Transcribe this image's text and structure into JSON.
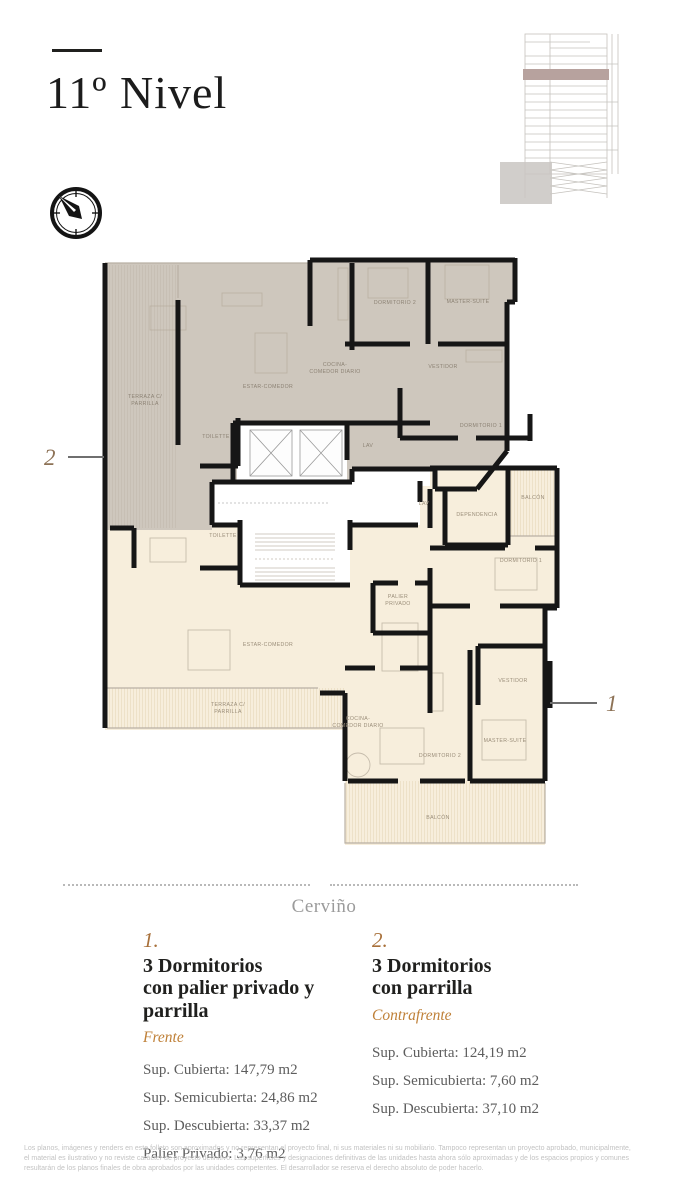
{
  "header": {
    "title": "11º Nivel"
  },
  "street": {
    "label": "Cerviño"
  },
  "plan": {
    "callout_1": "1",
    "callout_2": "2",
    "upper": {
      "terraza1": "TERRAZA C/",
      "terraza2": "PARRILLA",
      "estar": "ESTAR-COMEDOR",
      "cocina1": "COCINA-",
      "cocina2": "COMEDOR DIARIO",
      "dormitorio2": "DORMITORIO 2",
      "master": "MASTER-SUITE",
      "vestidor": "VESTIDOR",
      "dormitorio1": "DORMITORIO 1",
      "toilette": "TOILETTE",
      "lav": "LAV"
    },
    "lower": {
      "lav": "LAV",
      "toilette": "TOILETTE",
      "dependencia": "DEPENDENCIA",
      "balcon_top": "BALCÓN",
      "dormitorio1": "DORMITORIO 1",
      "palier1": "PALIER",
      "palier2": "PRIVADO",
      "estar": "ESTAR-COMEDOR",
      "terraza1": "TERRAZA C/",
      "terraza2": "PARRILLA",
      "cocina1": "COCINA-",
      "cocina2": "COMEDOR DIARIO",
      "dormitorio2": "DORMITORIO 2",
      "master": "MASTER-SUITE",
      "vestidor": "VESTIDOR",
      "balcon_bottom": "BALCÓN"
    }
  },
  "units": [
    {
      "number": "1.",
      "title": "3 Dormitorios\ncon palier privado y\nparrilla",
      "orientation": "Frente",
      "details": [
        "Sup. Cubierta: 147,79 m2",
        "Sup. Semicubierta: 24,86 m2",
        "Sup. Descubierta: 33,37 m2",
        "Palier Privado: 3,76 m2"
      ]
    },
    {
      "number": "2.",
      "title": "3 Dormitorios\ncon parrilla",
      "orientation": "Contrafrente",
      "details": [
        "Sup. Cubierta: 124,19 m2",
        "Sup. Semicubierta: 7,60 m2",
        "Sup. Descubierta: 37,10 m2"
      ]
    }
  ],
  "disclaimer": {
    "line1": "Los planos, imágenes y renders en este folleto son aproximados y no representan el proyecto final, ni sus materiales ni su mobiliario. Tampoco representan un proyecto aprobado, municipalmente,",
    "line2": "el material es ilustrativo y no reviste carácter de proyecto definitivo. Las superficies y designaciones definitivas de las unidades hasta ahora sólo aproximadas y de los espacios propios y comunes",
    "line3": "resultarán de los planos finales de obra aprobados por las unidades competentes. El desarrollador se reserva el derecho absoluto de poder hacerlo."
  },
  "colors": {
    "upper_unit_fill": "#cec7bd",
    "lower_unit_fill": "#f7eedc",
    "wall": "#161616",
    "accent_orange": "#bf8038",
    "callout_brown": "#8d7256",
    "elevation_highlight": "#b7a29e"
  }
}
